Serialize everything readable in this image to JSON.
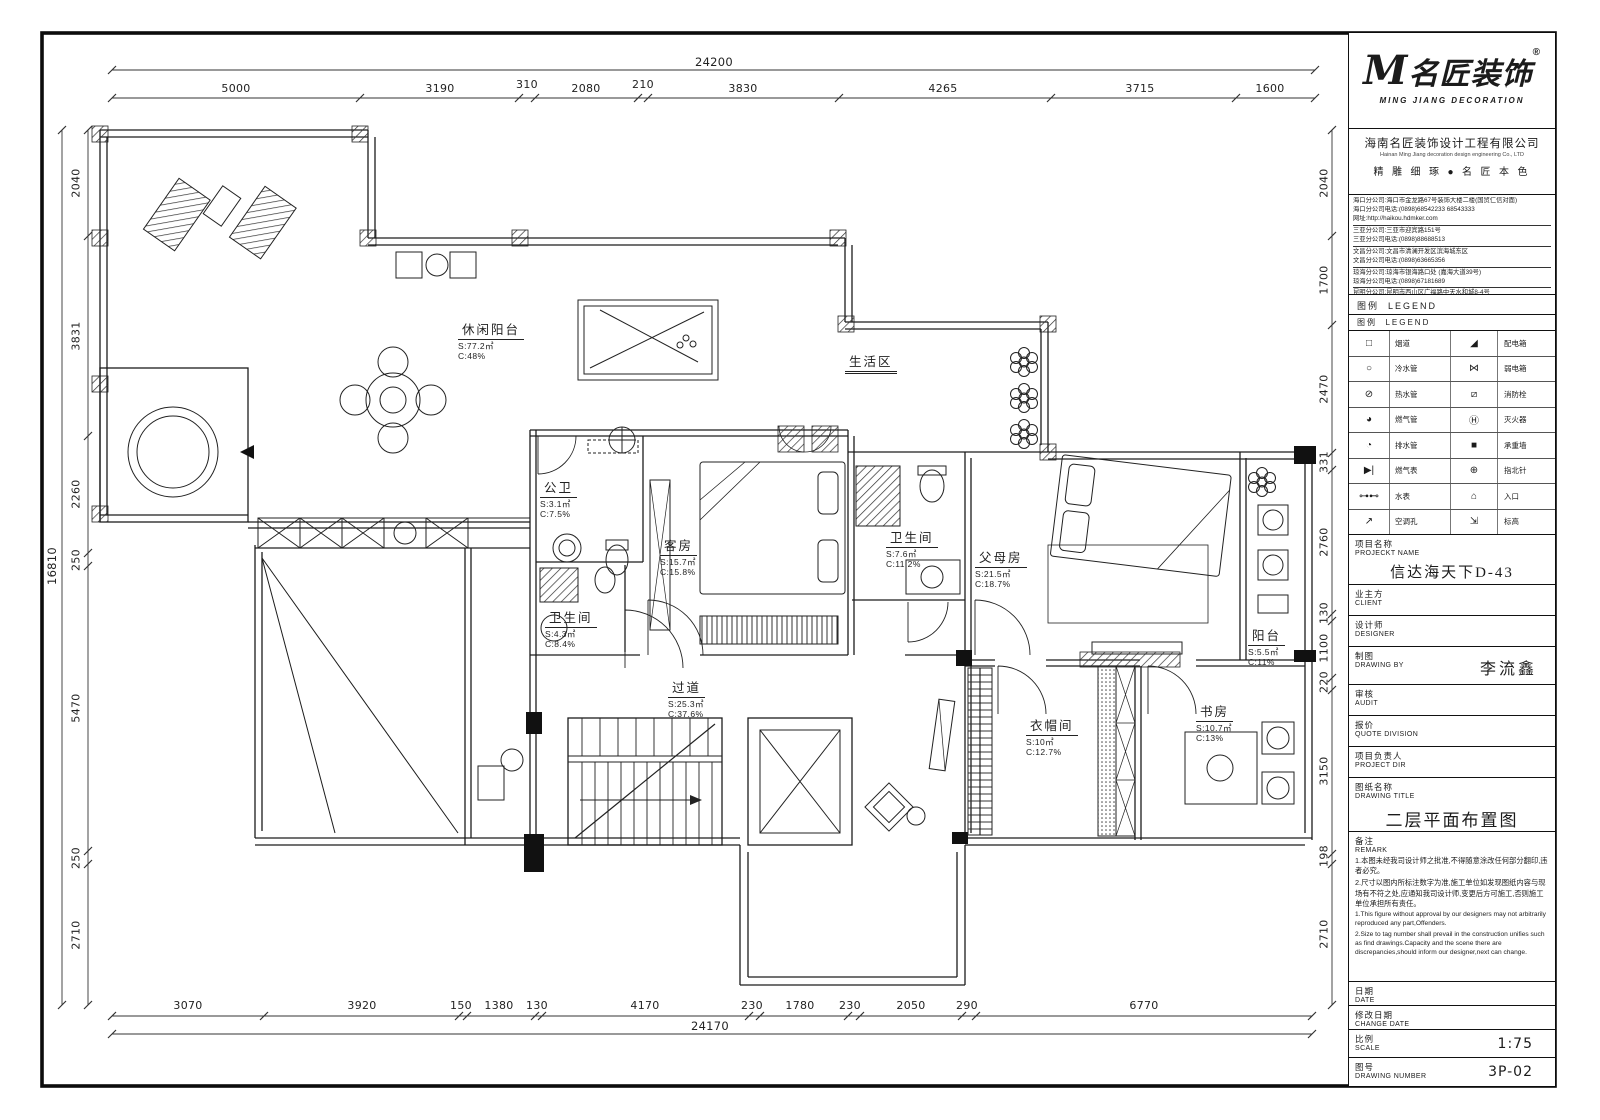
{
  "dims": {
    "top": {
      "total": "24200",
      "segments": [
        "5000",
        "3190",
        "310",
        "2080",
        "210",
        "3830",
        "4265",
        "3715",
        "1600"
      ]
    },
    "bottom": {
      "total": "24170",
      "segments": [
        "3070",
        "3920",
        "150",
        "1380",
        "130",
        "4170",
        "230",
        "1780",
        "230",
        "2050",
        "290",
        "6770"
      ]
    },
    "left": {
      "total": "16810",
      "segments": [
        "2040",
        "3831",
        "2260",
        "250",
        "5470",
        "250",
        "2710"
      ]
    },
    "right": {
      "segments": [
        "2040",
        "1700",
        "2470",
        "331",
        "2760",
        "130",
        "1100",
        "220",
        "3150",
        "198",
        "2710"
      ]
    }
  },
  "rooms": [
    {
      "name": "休闲阳台",
      "area": "S:77.2㎡",
      "ratio": "C:48%"
    },
    {
      "name": "生活区",
      "area": "",
      "ratio": ""
    },
    {
      "name": "公卫",
      "area": "S:3.1㎡",
      "ratio": "C:7.5%"
    },
    {
      "name": "客房",
      "area": "S:15.7㎡",
      "ratio": "C:15.8%"
    },
    {
      "name": "卫生间",
      "area": "S:4.3㎡",
      "ratio": "C:8.4%"
    },
    {
      "name": "卫生间",
      "area": "S:7.6㎡",
      "ratio": "C:11.2%"
    },
    {
      "name": "父母房",
      "area": "S:21.5㎡",
      "ratio": "C:18.7%"
    },
    {
      "name": "阳台",
      "area": "S:5.5㎡",
      "ratio": "C:11%"
    },
    {
      "name": "过道",
      "area": "S:25.3㎡",
      "ratio": "C:37.6%"
    },
    {
      "name": "衣帽间",
      "area": "S:10㎡",
      "ratio": "C:12.7%"
    },
    {
      "name": "书房",
      "area": "S:10.7㎡",
      "ratio": "C:13%"
    }
  ],
  "titleblock": {
    "logo": {
      "m": "M",
      "name": "名匠装饰",
      "reg": "®",
      "sub": "MING JIANG DECORATION"
    },
    "company_cn": "海南名匠装饰设计工程有限公司",
    "company_en": "Hainan Ming Jiang decoration design engineering Co., LTD",
    "slogan": "精 雕 细 琢 ● 名 匠 本 色",
    "branches": [
      "海口分公司:海口市金龙路67号装饰大楼二楼(国贸仁信对面)",
      "海口分公司电话:(0898)68542233 68543333",
      "网址:http://haikou.hdmker.com",
      "三亚分公司:三亚市迎宾路151号",
      "三亚分公司电话:(0898)88688513",
      "文昌分公司:文昌市清澜开发区滨海城东区",
      "文昌分公司电话:(0898)63665356",
      "琼海分公司:琼海市银海路口处 (嘉海大道39号)",
      "琼海分公司电话:(0898)67181689",
      "昆明分公司:昆明市西山区广福路中天水和城8-4号",
      "昆明分公司电话:(0871)64582202"
    ],
    "legend_title_cn": "图例",
    "legend_title_en": "LEGEND",
    "legend_rows": [
      {
        "lsym": "□",
        "llabel": "烟道",
        "rsym": "◢",
        "rlabel": "配电箱"
      },
      {
        "lsym": "○",
        "llabel": "冷水管",
        "rsym": "⋈",
        "rlabel": "弱电箱"
      },
      {
        "lsym": "⊘",
        "llabel": "热水管",
        "rsym": "⧄",
        "rlabel": "消防栓"
      },
      {
        "lsym": "◕",
        "llabel": "燃气管",
        "rsym": "Ⓗ",
        "rlabel": "灭火器"
      },
      {
        "lsym": "◔",
        "llabel": "排水管",
        "rsym": "■",
        "rlabel": "承重墙"
      },
      {
        "lsym": "▶|",
        "llabel": "燃气表",
        "rsym": "⊕",
        "rlabel": "指北针"
      },
      {
        "lsym": "⊶⊷",
        "llabel": "水表",
        "rsym": "⌂",
        "rlabel": "入口"
      },
      {
        "lsym": "↗",
        "llabel": "空调孔",
        "rsym": "⇲",
        "rlabel": "标高"
      }
    ],
    "rows": [
      {
        "cn": "项目名称",
        "en": "PROJECKT NAME",
        "value": "信达海天下D-43"
      },
      {
        "cn": "业主方",
        "en": "CLIENT",
        "value": ""
      },
      {
        "cn": "设计师",
        "en": "DESIGNER",
        "value": ""
      },
      {
        "cn": "制图",
        "en": "DRAWING BY",
        "value": "李流鑫"
      },
      {
        "cn": "审核",
        "en": "AUDIT",
        "value": ""
      },
      {
        "cn": "报价",
        "en": "QUOTE DIVISION",
        "value": ""
      },
      {
        "cn": "项目负责人",
        "en": "PROJECT DIR",
        "value": ""
      },
      {
        "cn": "图纸名称",
        "en": "DRAWING TITLE",
        "value": "二层平面布置图"
      }
    ],
    "remark": {
      "cn_title": "备注",
      "en_title": "REMARK",
      "cn": [
        "1.本图未经我司设计师之批准,不得随意涂改任何部分翻印,违者必究。",
        "2.尺寸以图内所标注数字为准,施工单位如发现图纸内容与现场有不符之处,应通知我司设计师,变更后方可施工,否则施工单位承担所有责任。"
      ],
      "en": [
        "1.This figure without approval by our designers may not arbitrarily reproduced any part,Offenders.",
        "2.Size to tag number shall prevail in the construction unifies such as find drawings.Capacity and the scene there are discrepancies,should inform our designer,next can change."
      ]
    },
    "footer": [
      {
        "cn": "日期",
        "en": "DATE",
        "value": ""
      },
      {
        "cn": "修改日期",
        "en": "CHANGE DATE",
        "value": ""
      },
      {
        "cn": "比例",
        "en": "SCALE",
        "value": "1:75"
      },
      {
        "cn": "图号",
        "en": "DRAWING NUMBER",
        "value": "3P-02"
      }
    ]
  }
}
